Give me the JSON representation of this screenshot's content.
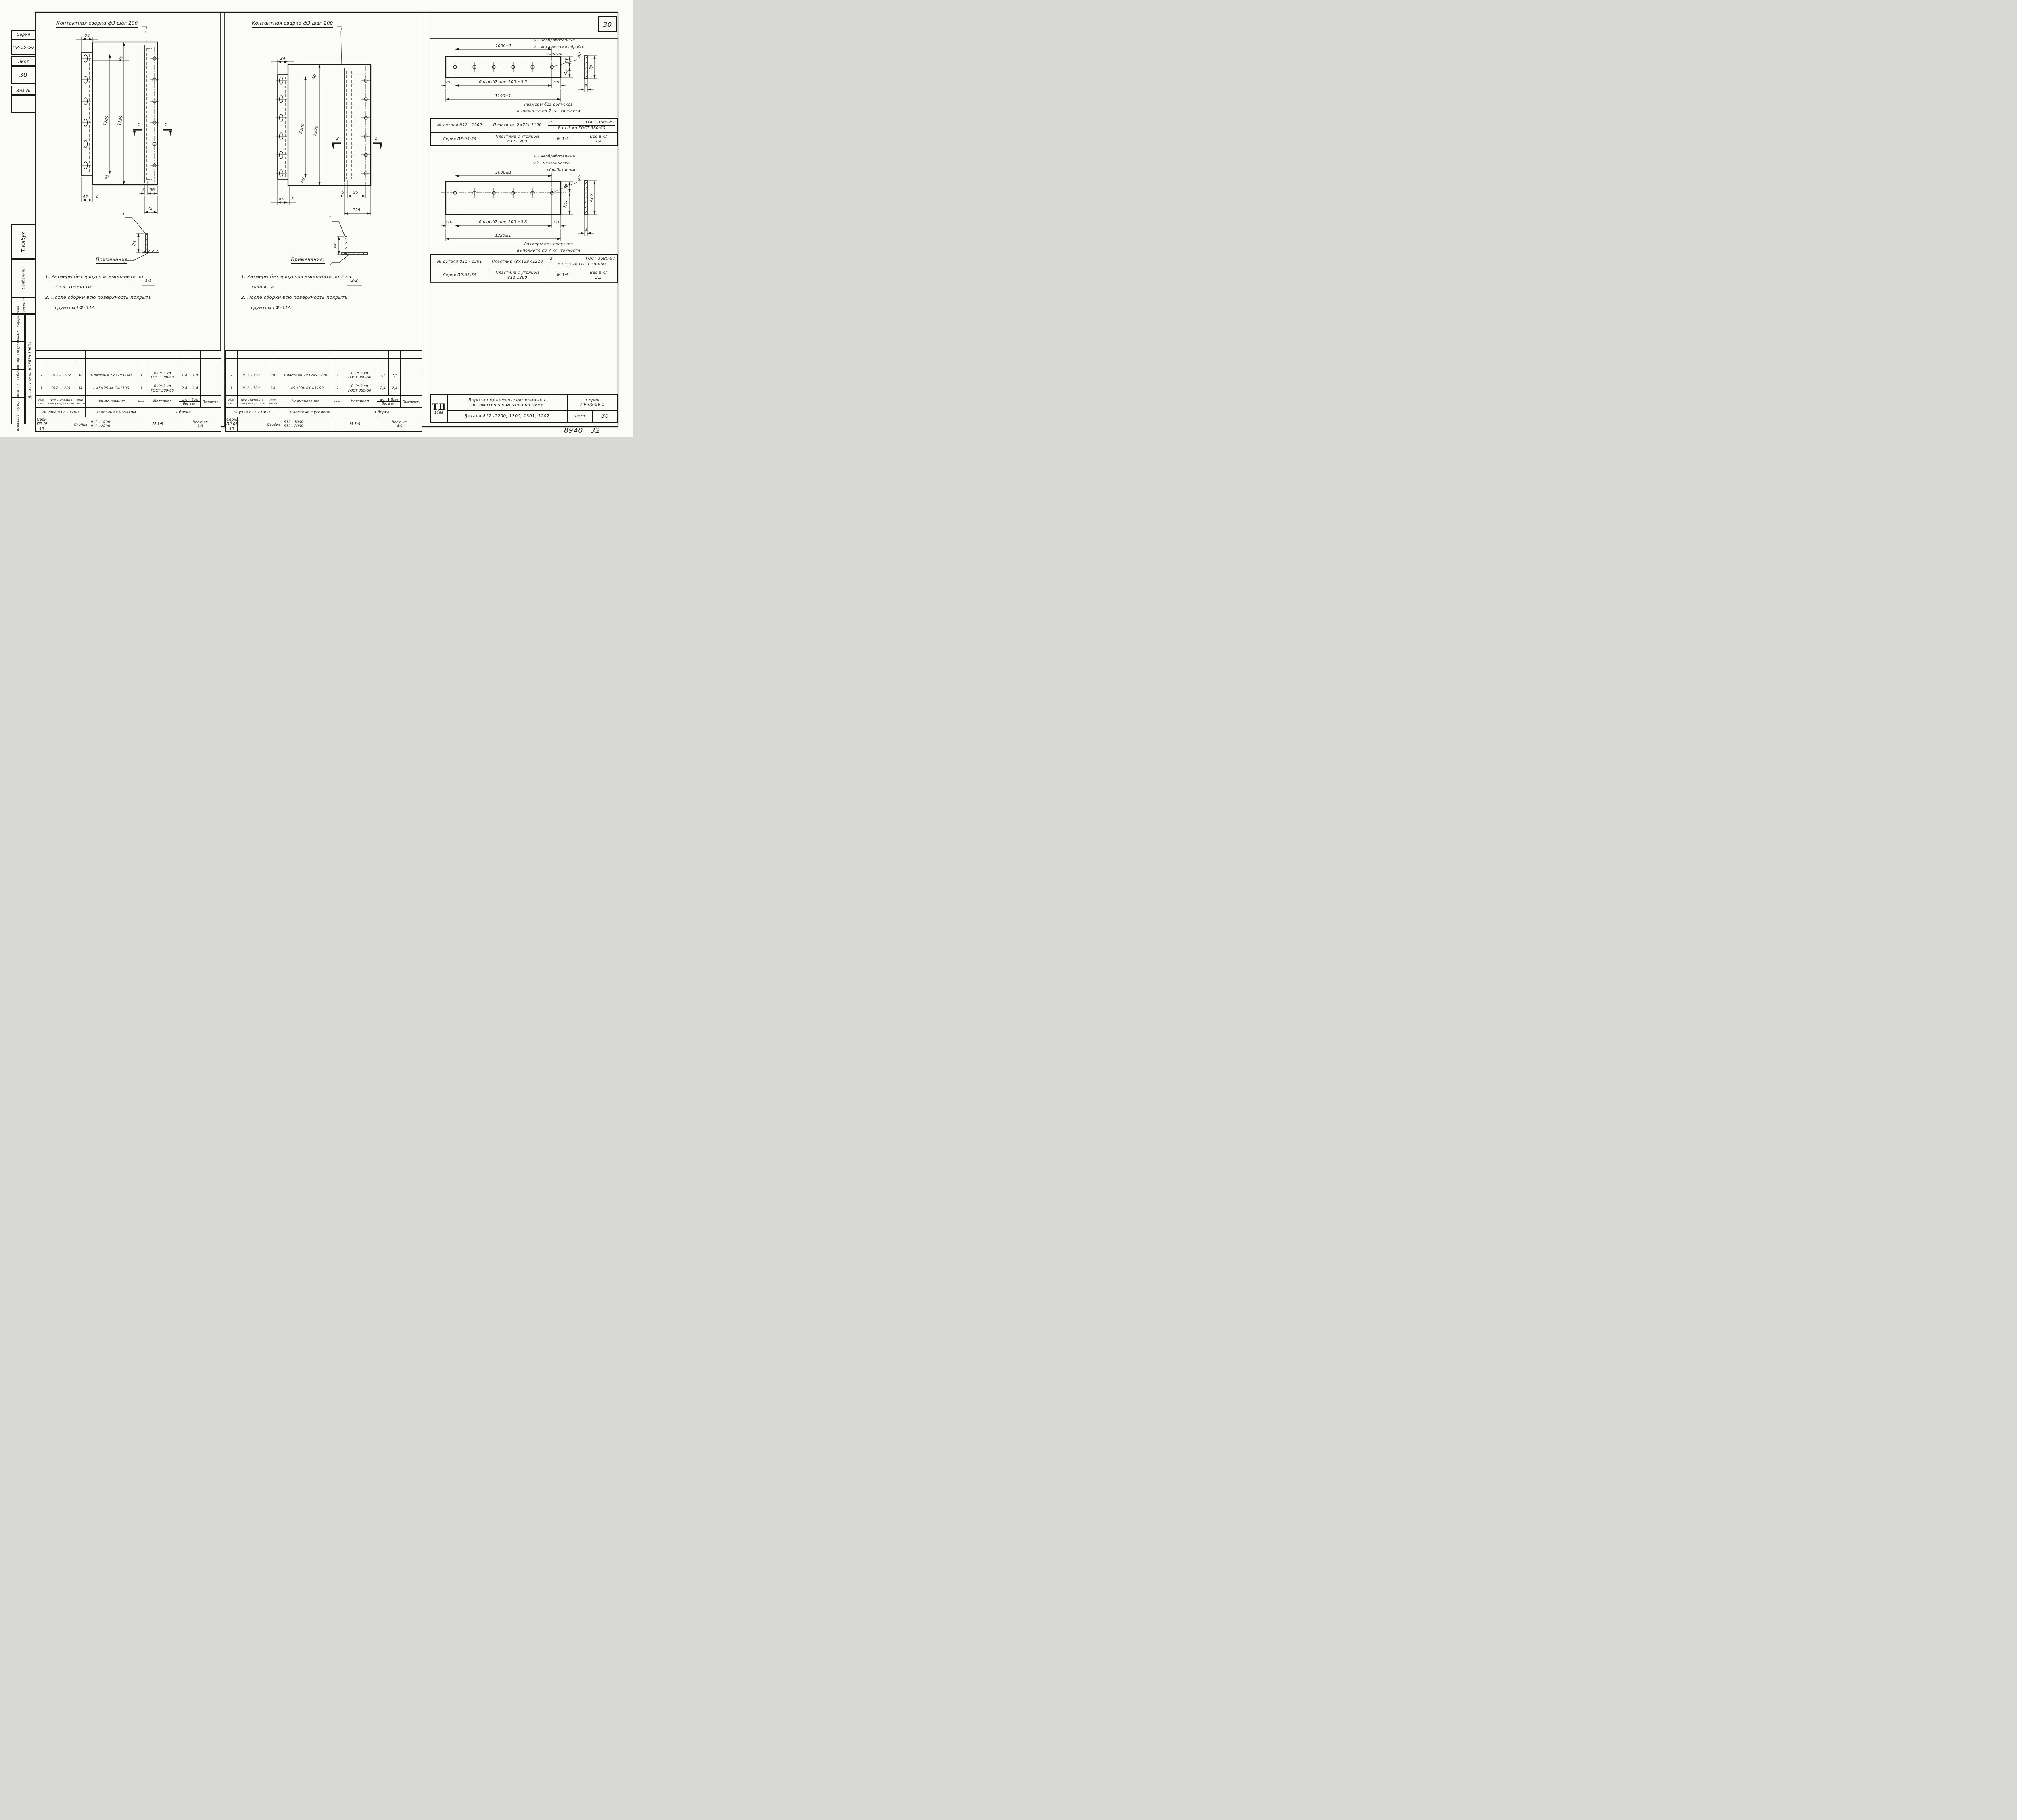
{
  "sheet": {
    "page_number": "30",
    "doc_number": "8940",
    "doc_sheet": "32",
    "sidebar": {
      "series_label": "Серия",
      "series_value": "ПР-05-56",
      "sheet_label": "Лист",
      "sheet_value": "30",
      "inv_label": "Инв №"
    },
    "stamp": {
      "signature": "Т.Кабул",
      "checked_name": "Солбачкин",
      "checked_label": "Проверил",
      "rows": [
        {
          "label": "Нач. СЕО-2",
          "name": "Подоровский"
        },
        {
          "label": "Гл. инж. пр.",
          "name": "Ондровский"
        },
        {
          "label": "Ст. инж. пр.",
          "name": "Собачкин"
        },
        {
          "label": "Исполнит.",
          "name": "Пузырькова"
        }
      ],
      "date_line": "Дата выпуска   НОЯБРЬ  1965 г."
    }
  },
  "panel1": {
    "weld_note": "Контактная  сварка  ф3  шаг 200",
    "dims": {
      "top24": "24",
      "t45": "45",
      "v1100": "1100",
      "v1190": "1190",
      "bl45": "45",
      "bl2": "2",
      "low45": "45",
      "r6": "6",
      "r38": "38",
      "r72": "72",
      "det24": "24"
    },
    "marks": {
      "sec": "1",
      "leader1": "1",
      "leader2": "2",
      "caption": "1-1"
    },
    "notes": {
      "title": "Примечания",
      "n1a": "1.   Размеры   без   допусков   выполнить   по",
      "n1b": "7 кл.   точности.",
      "n2a": "2.   После   сборки   всю   поверхность   покрыть",
      "n2b": "грунтом   ГФ-032."
    }
  },
  "panel2": {
    "weld_note": "Контактная  сварка  ф3  шаг 200",
    "dims": {
      "top24": "24",
      "t60": "60",
      "v1100": "1100",
      "v1220": "1220",
      "bl45": "45",
      "bl2": "2",
      "low60": "60",
      "r6": "6",
      "r95": "95",
      "r129": "129",
      "det24": "24"
    },
    "marks": {
      "sec": "2",
      "leader1": "1",
      "leader2": "2",
      "caption": "2-2"
    },
    "notes": {
      "title": "Примечания:",
      "n1a": "1.   Размеры   без   допусков   выполнить   по 7 кл.",
      "n1b": "точности.",
      "n2a": "2.   После   сборки   всю   поверхность   покрыть",
      "n2b": "грунтом   ГФ-032."
    }
  },
  "boxA": {
    "legend1": "≈  -  необработанные",
    "legend2": "▽ -  механически  обрабо-",
    "legend3": "танные",
    "dims": {
      "top": "1000±1",
      "left": "95",
      "mid": "6 отв  ф7   шаг  200 ±0,5",
      "right": "95",
      "bottom": "1190±1",
      "e28": "28",
      "e44": "44",
      "f7": "ф7",
      "s72": "72",
      "s2": "2"
    },
    "note1": "Размеры  без  допусков",
    "note2": "выполните  по 7 кл. точности",
    "table": {
      "r1c1": "№ детали  812 - 1202",
      "r1c2": "Пластина  -2×72×1190",
      "frac_n1": "-2",
      "frac_n2": "ГОСТ 3680-57",
      "frac_d": "В ст.3 кп ГОСТ 380-60",
      "r2c1": "Серия ПР-05-56",
      "r2c2a": "Пластина  с  уголком",
      "r2c2b": "812-1200",
      "r2c3": "М 1:5",
      "r2c4a": "Вес в кг",
      "r2c4b": "1,4"
    }
  },
  "boxB": {
    "legend1": "≈  -  необработанные",
    "legend2": "▽3 -  механически",
    "legend3": "обработанные",
    "dims": {
      "top": "1000±1",
      "left": "110",
      "mid": "6 отв  ф7   шаг  200 ±0,8",
      "right": "110",
      "bottom": "1220±1",
      "e28": "28",
      "e101": "101",
      "f7": "ф7",
      "s129": "129",
      "s2": "2"
    },
    "note1": "Размеры  без  допусков",
    "note2": "выполните  по 7 кл. точности",
    "table": {
      "r1c1": "№ детали  812 - 1301",
      "r1c2": "Пластина   -2×129×1220",
      "frac_n1": "-2",
      "frac_n2": "ГОСТ 3680-57",
      "frac_d": "В Ст.3 кп ГОСТ 380-60",
      "r2c1": "Серия ПР-05-56",
      "r2c2a": "Пластина  с  уголком",
      "r2c2b": "812-1300",
      "r2c3": "М 1:5",
      "r2c4a": "Вес в кг",
      "r2c4b": "2,5"
    }
  },
  "titleblock": {
    "logo": "ТД",
    "year": "1965",
    "title1": "Ворота   подъемно- секционные   с",
    "title2": "автоматическим      управлением",
    "series_label": "Серия",
    "series_value": "ПР-05-56.1",
    "details": "Детали   812 -1200, 1300, 1301, 1202.",
    "sheet_label": "Лист",
    "sheet_value": "30"
  },
  "btable": {
    "headers": {
      "pos": "№№ поз.",
      "std": "№№ стандарта или узла, детали",
      "list": "№№ листа",
      "name": "Наименование",
      "qty": "Кол.",
      "mat": "Материал",
      "sht": "шт.",
      "all": "Всех",
      "weight": "Вес в кг.",
      "note": "Примечан."
    },
    "left": {
      "rows": [
        {
          "pos": "2",
          "std": "812 - 1202",
          "list": "30",
          "name": "Пластина  2×72×1190",
          "qty": "1",
          "mat1": "В  Ст.3 кп",
          "mat2": "ГОСТ 380-60",
          "w1": "1,4",
          "w2": "1,4",
          "note": ""
        },
        {
          "pos": "1",
          "std": "812 - 1201",
          "list": "34",
          "name": "L 45×28×4   С=1100",
          "qty": "1",
          "mat1": "В Ст.3  кп",
          "mat2": "ГОСТ 380-60",
          "w1": "2,4",
          "w2": "2,4",
          "note": ""
        }
      ],
      "f1c1": "№ узла   812 - 1200",
      "f1c2": "Пластина  с  уголком",
      "f1c3": "Сборка",
      "f2c1": "Серия ПР-05-56",
      "f2c2a": "Стойка",
      "f2c2b": "812 - 1000",
      "f2c2c": "812 - 2000",
      "f2c3": "М 1:5",
      "f2c4a": "Вес в кг",
      "f2c4b": "3,8"
    },
    "middle": {
      "rows": [
        {
          "pos": "2",
          "std": "812 - 1301",
          "list": "30",
          "name": "Пластина 2×129×1220",
          "qty": "1",
          "mat1": "В  Ст.3 кп",
          "mat2": "ГОСТ 380-60",
          "w1": "2,5",
          "w2": "2,5",
          "note": ""
        },
        {
          "pos": "1",
          "std": "812 - 1201",
          "list": "34",
          "name": "L 45×28×4   С=1100",
          "qty": "1",
          "mat1": "В Ст.3  кп",
          "mat2": "ГОСТ 380-60",
          "w1": "2,4",
          "w2": "2,4",
          "note": ""
        }
      ],
      "f1c1": "№ узла   812 - 1300",
      "f1c2": "Пластина  с  уголком",
      "f1c3": "Сборка",
      "f2c1": "Серия ПР-05-56",
      "f2c2a": "Стойка",
      "f2c2b": "812 - 1000",
      "f2c2c": "812 - 2000",
      "f2c3": "М 1:5",
      "f2c4a": "Вес в кг.",
      "f2c4b": "4,9"
    }
  }
}
